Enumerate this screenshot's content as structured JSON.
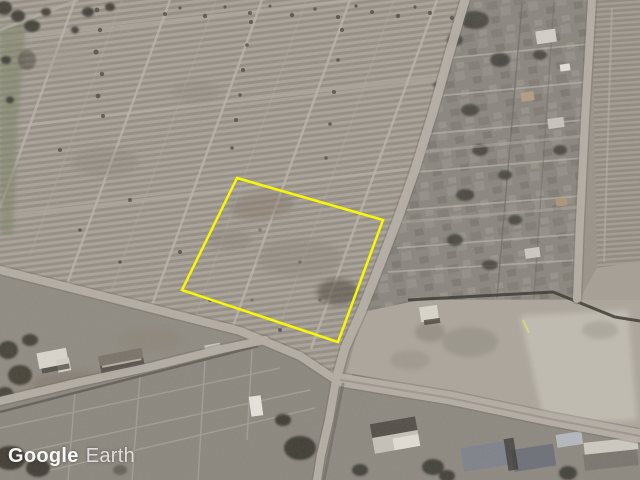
{
  "watermark": {
    "brand": "Google",
    "product": "Earth",
    "text_color": "#ffffff"
  },
  "annotation": {
    "type": "polygon-outline",
    "polygon_points": "237,178 383,220 338,342 182,290",
    "stroke_color": "#f8f800",
    "stroke_width": 2.5
  },
  "scene": {
    "type": "satellite-aerial-imagery",
    "palette": {
      "field_base": "#99938a",
      "field_ridge_light": "#a8a298",
      "field_ridge_dark": "#8f897f",
      "road": "#b5afa6",
      "village_shadow": "#3d3a35",
      "yard_light": "#c3beb4",
      "vegetation": "#7b8266"
    }
  }
}
